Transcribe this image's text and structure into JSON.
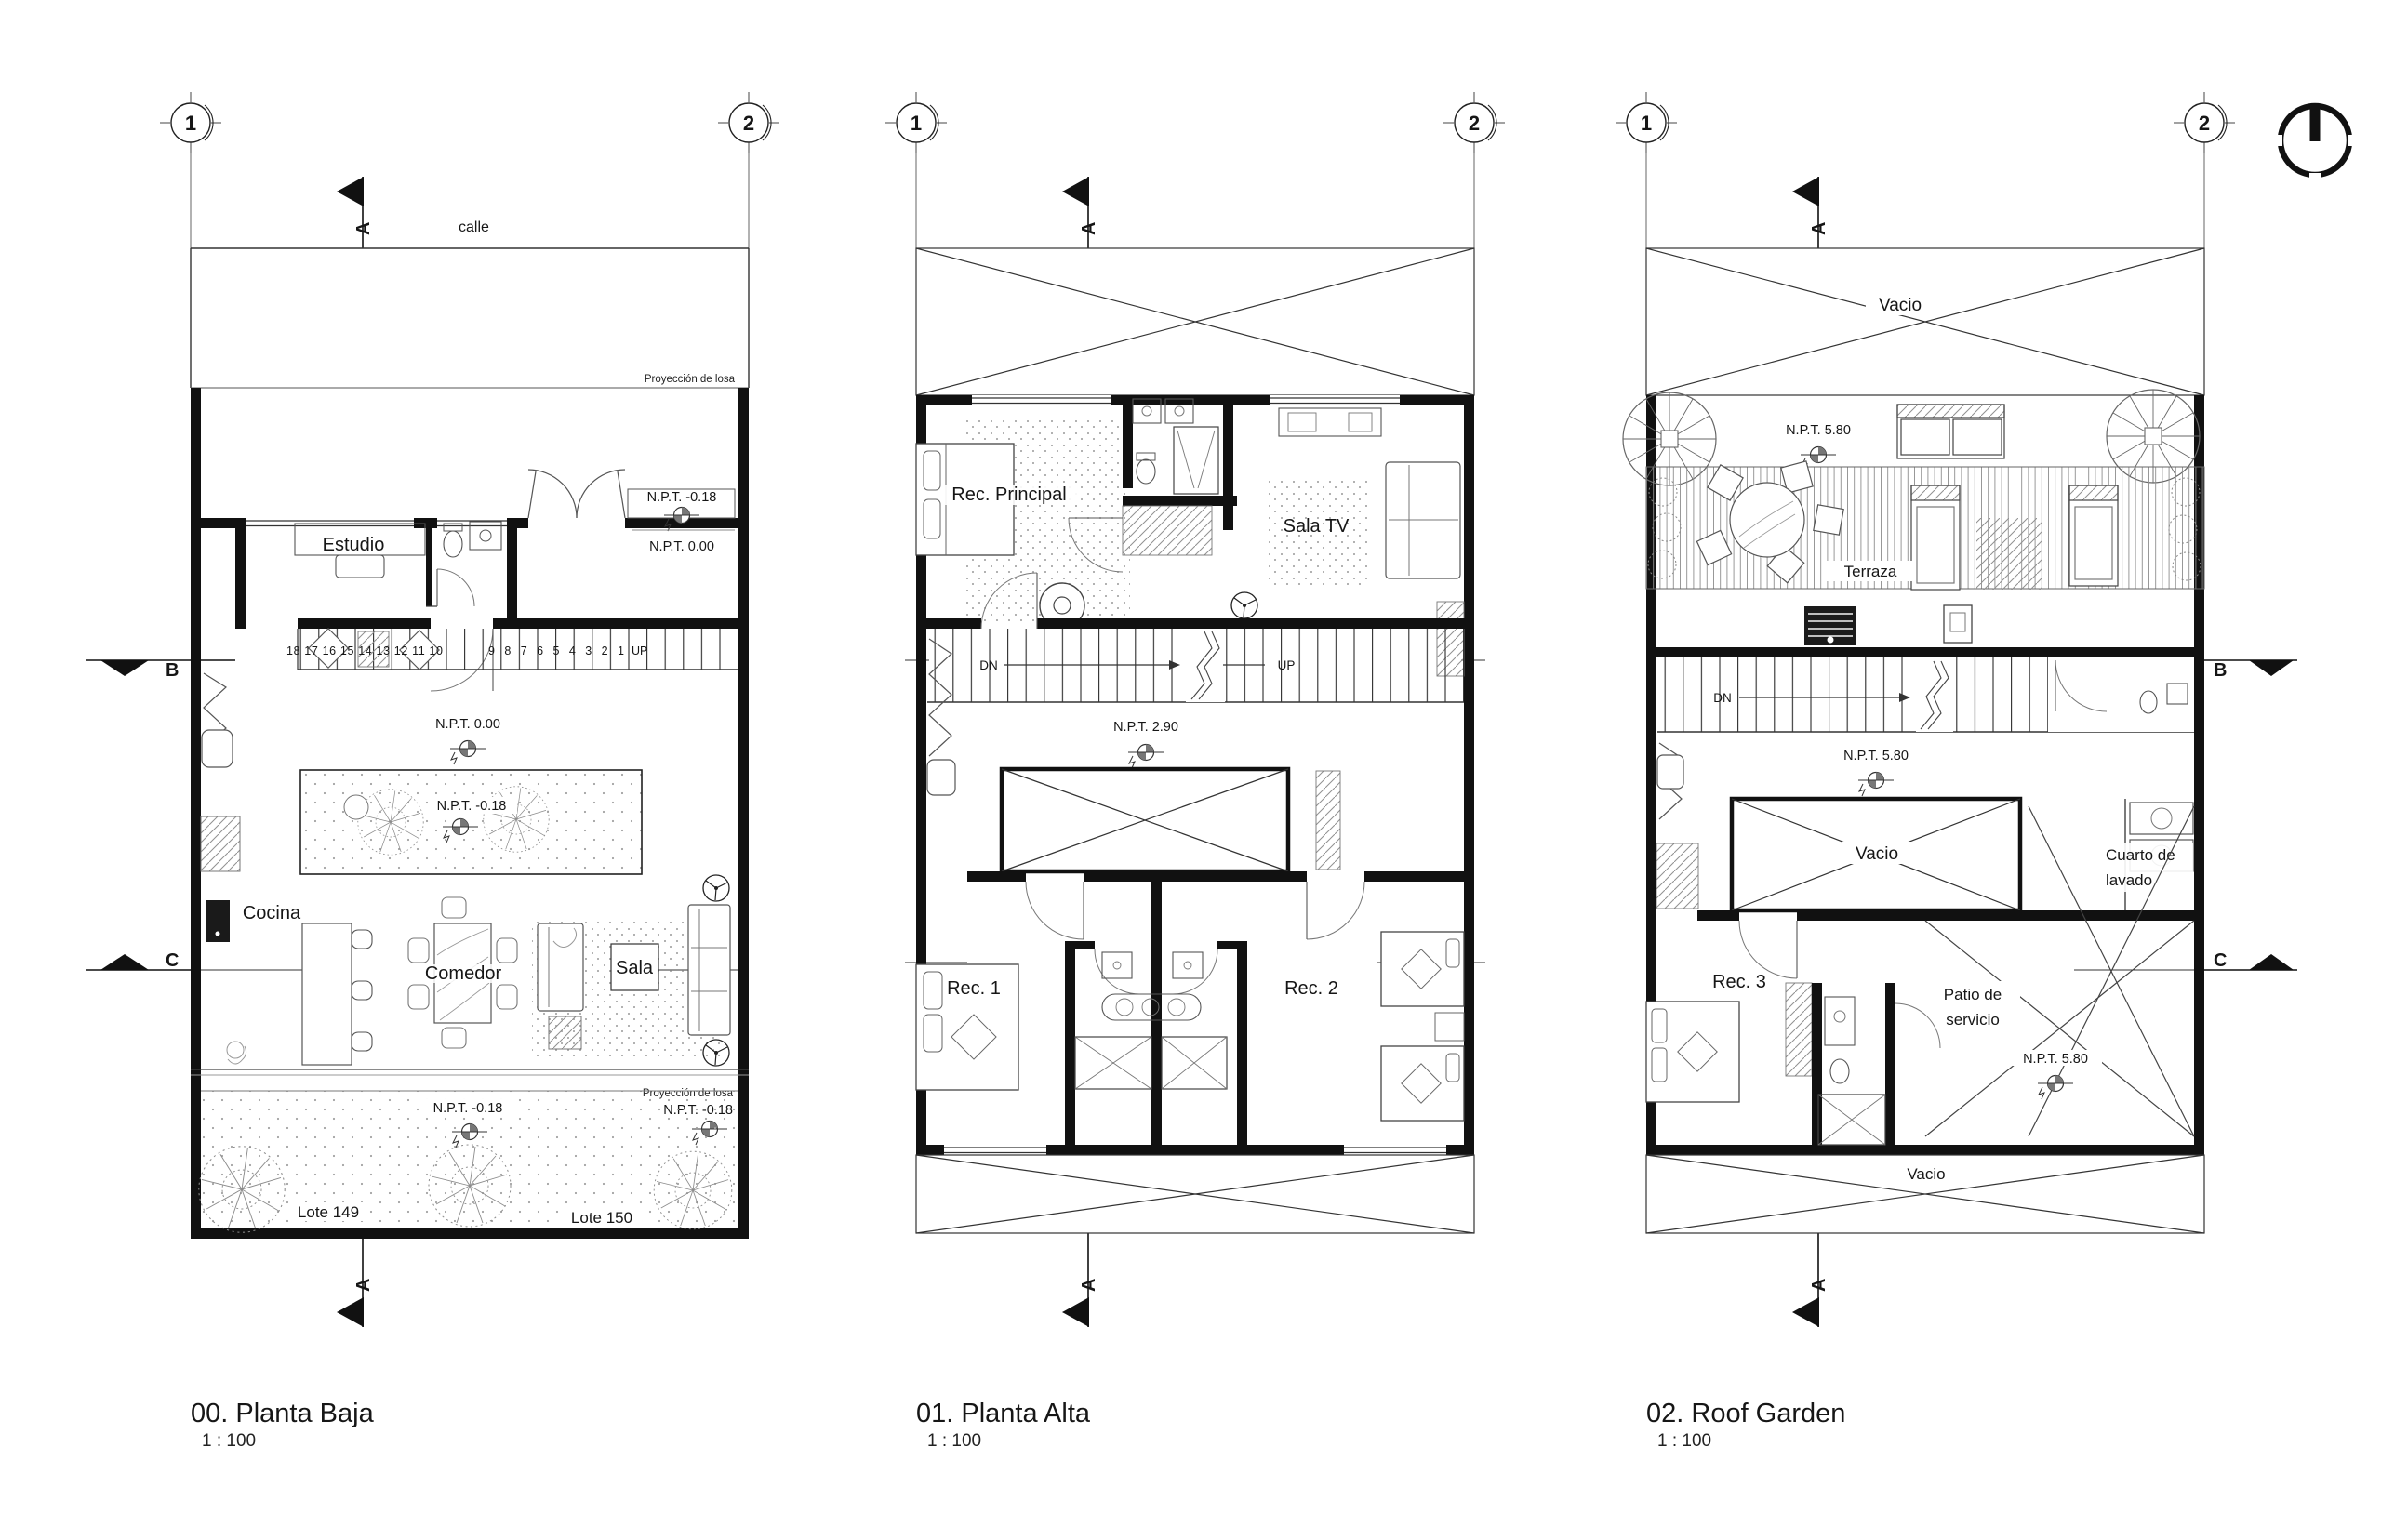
{
  "plans": [
    {
      "name": "planta-baja",
      "title": "00. Planta Baja",
      "scale": "1 : 100",
      "grid_left": "1",
      "grid_right": "2",
      "section_a": "A",
      "section_b": "B",
      "section_c": "C",
      "street": "calle",
      "slab_top": "Proyección de losa",
      "slab_bottom": "Proyección de losa",
      "npt_porch": "N.P.T. -0.18",
      "npt_entry": "N.P.T. 0.00",
      "npt_hall": "N.P.T. 0.00",
      "npt_patio": "N.P.T. -0.18",
      "npt_slab": "N.P.T. -0.18",
      "npt_garden": "N.P.T. -0.18",
      "rooms": {
        "estudio": "Estudio",
        "cocina": "Cocina",
        "comedor": "Comedor",
        "sala": "Sala"
      },
      "stair_run_a": "18 17 16 15 14 13 12 11 10",
      "stair_run_b": "9 8 7 6 5 4 3 2 1",
      "stair_up": "UP",
      "lote_izq": "Lote 149",
      "lote_der": "Lote 150"
    },
    {
      "name": "planta-alta",
      "title": "01. Planta Alta",
      "scale": "1 : 100",
      "grid_left": "1",
      "grid_right": "2",
      "section_a": "A",
      "rooms": {
        "rec_principal": "Rec. Principal",
        "sala_tv": "Sala TV",
        "rec1": "Rec. 1",
        "rec2": "Rec. 2"
      },
      "stair_dn": "DN",
      "stair_up": "UP",
      "npt_hall": "N.P.T. 2.90"
    },
    {
      "name": "roof-garden",
      "title": "02. Roof Garden",
      "scale": "1 : 100",
      "grid_left": "1",
      "grid_right": "2",
      "section_a": "A",
      "section_b": "B",
      "section_c": "C",
      "vacio_top": "Vacio",
      "vacio_mid": "Vacio",
      "vacio_bottom": "Vacio",
      "terraza": "Terraza",
      "npt_terraza": "N.P.T. 5.80",
      "npt_hall": "N.P.T. 5.80",
      "npt_patio": "N.P.T. 5.80",
      "stair_dn": "DN",
      "rooms": {
        "rec3": "Rec. 3",
        "cuarto_lavado_1": "Cuarto de",
        "cuarto_lavado_2": "lavado",
        "patio_servicio_1": "Patio de",
        "patio_servicio_2": "servicio"
      }
    }
  ]
}
